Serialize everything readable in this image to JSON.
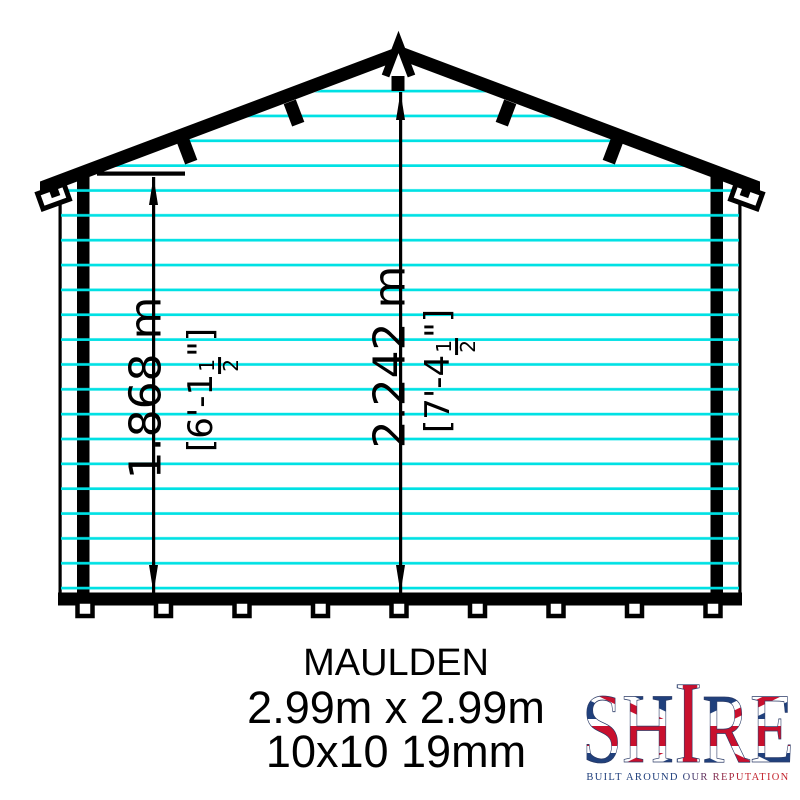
{
  "drawing": {
    "name": "shed-rear-elevation",
    "cladding_color": "#00e1e4",
    "ink_color": "#000000",
    "cladding_line_count": 21
  },
  "dimensions": {
    "eaves_height": {
      "metric": "1.868 m",
      "imperial_open": "[6'-1",
      "fraction_numerator": "1",
      "fraction_denominator": "2",
      "imperial_close": "\"]"
    },
    "ridge_height": {
      "metric": "2.242 m",
      "imperial_open": "[7'-4",
      "fraction_numerator": "1",
      "fraction_denominator": "2",
      "imperial_close": "\"]"
    }
  },
  "title_block": {
    "model": "MAULDEN",
    "size": "2.99m x 2.99m",
    "spec": "10x10 19mm"
  },
  "logo": {
    "brand": "SHIRE",
    "letters": [
      "S",
      "H",
      "I",
      "R",
      "E"
    ],
    "tagline": "BUILT AROUND OUR REPUTATION",
    "blue": "#1d3d7b",
    "red": "#c3222c"
  }
}
